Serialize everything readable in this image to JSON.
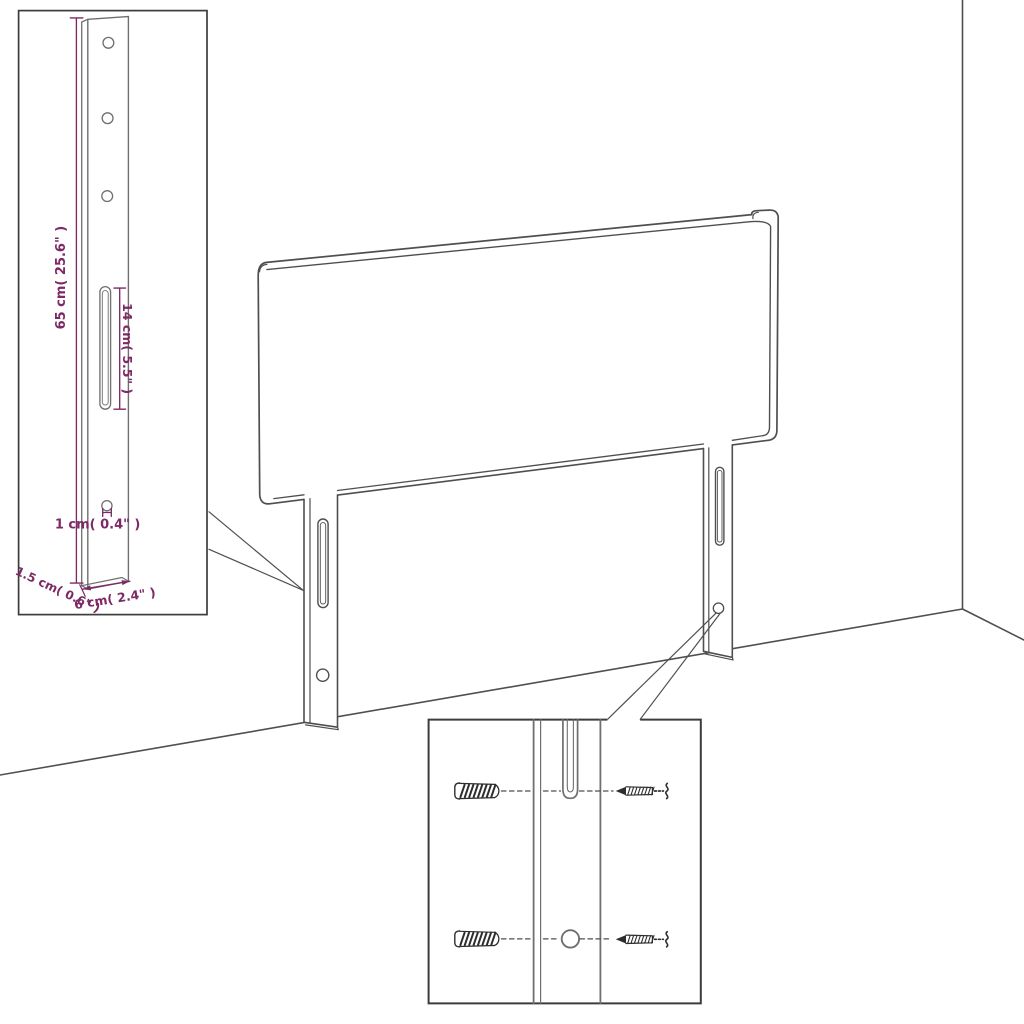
{
  "title": "Headboard with legs - dimension diagram",
  "colors": {
    "background": "#ffffff",
    "line": "#4f4f4f",
    "line_soft": "#6f6f6f",
    "inset_border": "#3c3c3c",
    "hardware": "#2e2e2e",
    "dimension": "#7d2964"
  },
  "leg_detail_inset": {
    "height_label": "65 cm( 25.6\" )",
    "slot_length_label": "14 cm( 5.5\" )",
    "hole_diameter_label": "1 cm( 0.4\" )",
    "thickness_label": "1.5 cm( 0.6\" )",
    "width_label": "6 cm( 2.4\" )"
  },
  "mounting_detail_inset": {
    "icons": [
      "wall-plug-icon",
      "screw-icon"
    ]
  }
}
